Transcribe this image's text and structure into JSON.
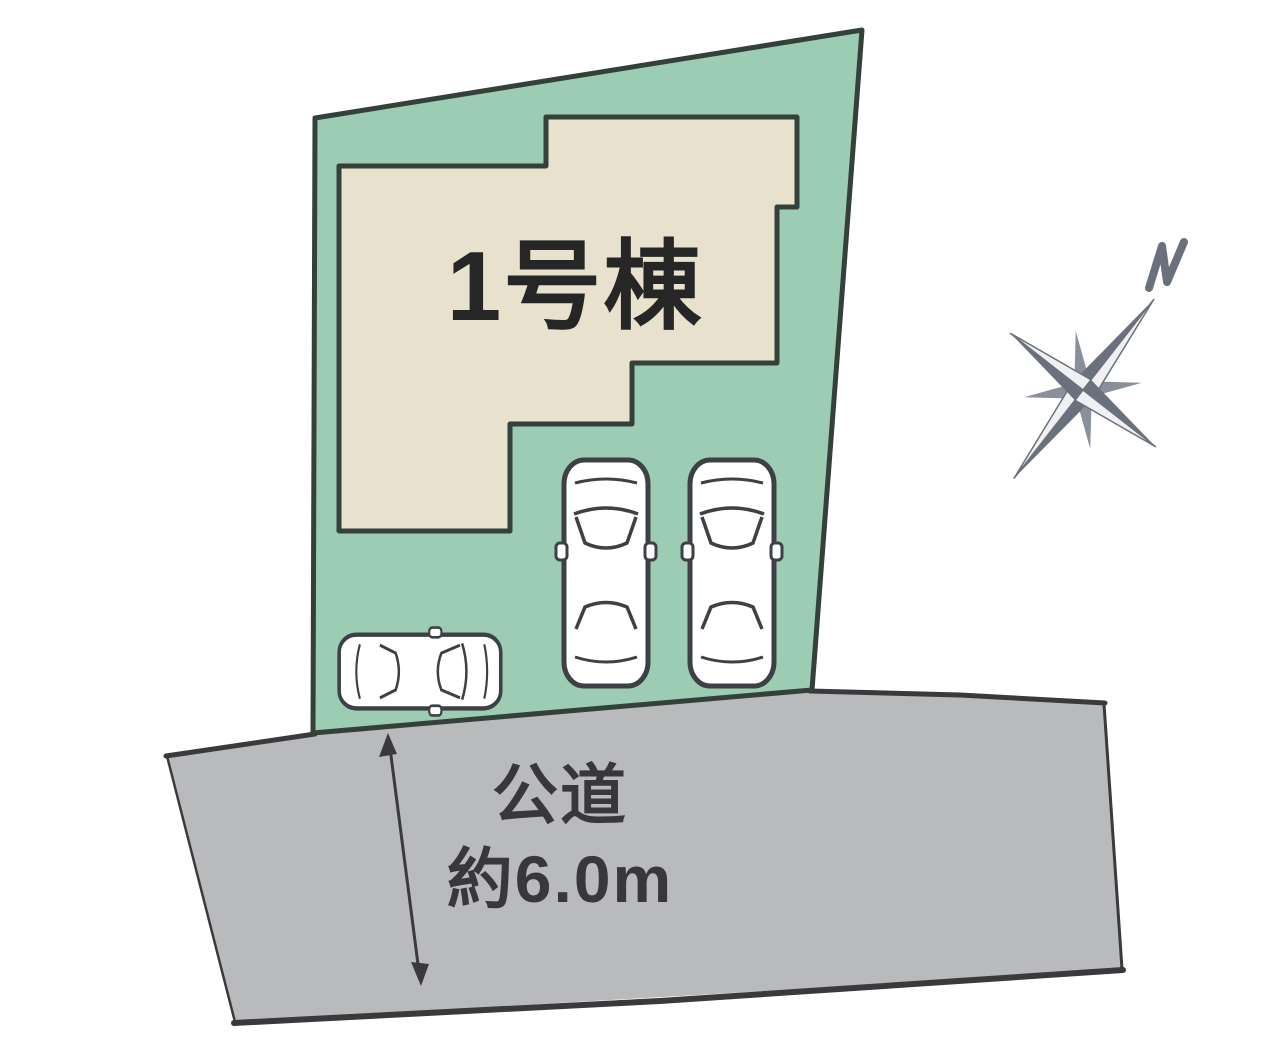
{
  "diagram": {
    "building": {
      "label": "1号棟"
    },
    "road": {
      "label": "公道",
      "width_label": "約6.0m"
    },
    "compass": {
      "north_label": "N"
    },
    "colors": {
      "plot_fill": "#9cccb3",
      "building_fill": "#e8e1ce",
      "outline_dark": "#35403b",
      "road_fill": "#b9babc",
      "road_edge": "#3a3a3c",
      "label_dark": "#262626",
      "road_text": "#38383a",
      "car_outline": "#3d4145",
      "car_fill": "#ffffff",
      "compass_dark": "#6b717c",
      "compass_mid": "#8a9099",
      "compass_light": "#eef0f2"
    }
  }
}
